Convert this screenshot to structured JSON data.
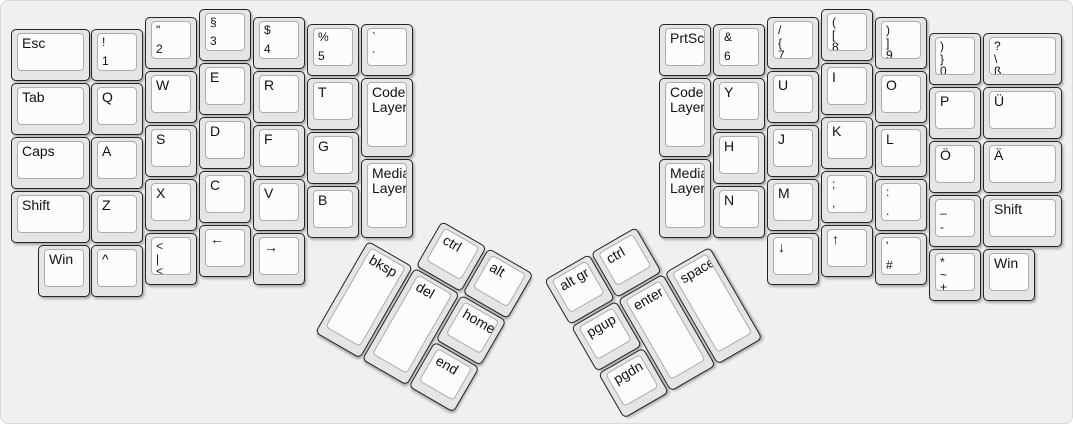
{
  "diagram": {
    "type": "split-ergonomic-keyboard-layout",
    "halves": [
      "left",
      "right"
    ],
    "layer_keys": [
      "Code Layer",
      "Media Layer"
    ]
  },
  "colors": {
    "canvas_bg": "#f0f0f0",
    "canvas_border": "#d9d9d9",
    "key_side": "#e5e5e5",
    "key_border": "#242424",
    "keytop_bg": "#fcfcfc",
    "keytop_border": "#adadad",
    "legend": "#111111"
  },
  "keyboard": {
    "unit_px": 54,
    "clusters": [
      {
        "id": "main",
        "x": 0,
        "y": 0,
        "angle": 0
      },
      {
        "id": "left-thumb",
        "x": 394,
        "y": 193,
        "angle": 30
      },
      {
        "id": "right-thumb",
        "x": 543,
        "y": 279,
        "angle": -30
      }
    ],
    "keys": [
      {
        "id": "esc",
        "cluster": "main",
        "x": 10,
        "y": 28,
        "w": 79,
        "h": 52,
        "labels": [
          "Esc"
        ]
      },
      {
        "id": "tab",
        "cluster": "main",
        "x": 10,
        "y": 82,
        "w": 79,
        "h": 52,
        "labels": [
          "Tab"
        ]
      },
      {
        "id": "caps",
        "cluster": "main",
        "x": 10,
        "y": 136,
        "w": 79,
        "h": 52,
        "labels": [
          "Caps"
        ]
      },
      {
        "id": "shift-left",
        "cluster": "main",
        "x": 10,
        "y": 190,
        "w": 79,
        "h": 52,
        "labels": [
          "Shift"
        ]
      },
      {
        "id": "win-left",
        "cluster": "main",
        "x": 37,
        "y": 244,
        "w": 52,
        "h": 52,
        "labels": [
          "Win"
        ]
      },
      {
        "id": "num1",
        "cluster": "main",
        "x": 90,
        "y": 28,
        "w": 52,
        "h": 52,
        "labels": [
          "!",
          "1"
        ]
      },
      {
        "id": "q",
        "cluster": "main",
        "x": 90,
        "y": 82,
        "w": 52,
        "h": 52,
        "labels": [
          "Q"
        ]
      },
      {
        "id": "a",
        "cluster": "main",
        "x": 90,
        "y": 136,
        "w": 52,
        "h": 52,
        "labels": [
          "A"
        ]
      },
      {
        "id": "z",
        "cluster": "main",
        "x": 90,
        "y": 190,
        "w": 52,
        "h": 52,
        "labels": [
          "Z"
        ]
      },
      {
        "id": "caret",
        "cluster": "main",
        "x": 90,
        "y": 244,
        "w": 52,
        "h": 52,
        "labels": [
          "^"
        ]
      },
      {
        "id": "num2",
        "cluster": "main",
        "x": 144,
        "y": 16,
        "w": 52,
        "h": 52,
        "labels": [
          "\"",
          "2"
        ]
      },
      {
        "id": "w",
        "cluster": "main",
        "x": 144,
        "y": 70,
        "w": 52,
        "h": 52,
        "labels": [
          "W"
        ]
      },
      {
        "id": "s",
        "cluster": "main",
        "x": 144,
        "y": 124,
        "w": 52,
        "h": 52,
        "labels": [
          "S"
        ]
      },
      {
        "id": "x",
        "cluster": "main",
        "x": 144,
        "y": 178,
        "w": 52,
        "h": 52,
        "labels": [
          "X"
        ]
      },
      {
        "id": "angle-pipe",
        "cluster": "main",
        "x": 144,
        "y": 232,
        "w": 52,
        "h": 52,
        "labels": [
          "<",
          "|",
          "<"
        ]
      },
      {
        "id": "num3",
        "cluster": "main",
        "x": 198,
        "y": 8,
        "w": 52,
        "h": 52,
        "labels": [
          "§",
          "3"
        ]
      },
      {
        "id": "e",
        "cluster": "main",
        "x": 198,
        "y": 62,
        "w": 52,
        "h": 52,
        "labels": [
          "E"
        ]
      },
      {
        "id": "d",
        "cluster": "main",
        "x": 198,
        "y": 116,
        "w": 52,
        "h": 52,
        "labels": [
          "D"
        ]
      },
      {
        "id": "c",
        "cluster": "main",
        "x": 198,
        "y": 170,
        "w": 52,
        "h": 52,
        "labels": [
          "C"
        ]
      },
      {
        "id": "arrow-left",
        "cluster": "main",
        "x": 198,
        "y": 224,
        "w": 52,
        "h": 52,
        "labels": [
          "←"
        ]
      },
      {
        "id": "num4",
        "cluster": "main",
        "x": 252,
        "y": 16,
        "w": 52,
        "h": 52,
        "labels": [
          "$",
          "4"
        ]
      },
      {
        "id": "r",
        "cluster": "main",
        "x": 252,
        "y": 70,
        "w": 52,
        "h": 52,
        "labels": [
          "R"
        ]
      },
      {
        "id": "f",
        "cluster": "main",
        "x": 252,
        "y": 124,
        "w": 52,
        "h": 52,
        "labels": [
          "F"
        ]
      },
      {
        "id": "v",
        "cluster": "main",
        "x": 252,
        "y": 178,
        "w": 52,
        "h": 52,
        "labels": [
          "V"
        ]
      },
      {
        "id": "arrow-right",
        "cluster": "main",
        "x": 252,
        "y": 232,
        "w": 52,
        "h": 52,
        "labels": [
          "→"
        ]
      },
      {
        "id": "num5",
        "cluster": "main",
        "x": 306,
        "y": 23,
        "w": 52,
        "h": 52,
        "labels": [
          "%",
          "5"
        ]
      },
      {
        "id": "t",
        "cluster": "main",
        "x": 306,
        "y": 77,
        "w": 52,
        "h": 52,
        "labels": [
          "T"
        ]
      },
      {
        "id": "g",
        "cluster": "main",
        "x": 306,
        "y": 131,
        "w": 52,
        "h": 52,
        "labels": [
          "G"
        ]
      },
      {
        "id": "b",
        "cluster": "main",
        "x": 306,
        "y": 185,
        "w": 52,
        "h": 52,
        "labels": [
          "B"
        ]
      },
      {
        "id": "grave-acute",
        "cluster": "main",
        "x": 360,
        "y": 23,
        "w": 52,
        "h": 52,
        "labels": [
          "`",
          "´"
        ]
      },
      {
        "id": "code-layer-left",
        "cluster": "main",
        "x": 360,
        "y": 77,
        "w": 52,
        "h": 79,
        "labels": [
          "Code Layer"
        ]
      },
      {
        "id": "media-layer-left",
        "cluster": "main",
        "x": 360,
        "y": 158,
        "w": 52,
        "h": 79,
        "labels": [
          "Media Layer"
        ]
      },
      {
        "id": "ctrl-left",
        "cluster": "left-thumb",
        "x": 54,
        "y": 0,
        "w": 52,
        "h": 52,
        "labels": [
          "ctrl"
        ]
      },
      {
        "id": "alt",
        "cluster": "left-thumb",
        "x": 108,
        "y": 0,
        "w": 52,
        "h": 52,
        "labels": [
          "alt"
        ]
      },
      {
        "id": "bksp",
        "cluster": "left-thumb",
        "x": 0,
        "y": 54,
        "w": 52,
        "h": 106,
        "labels": [
          "bksp"
        ]
      },
      {
        "id": "del",
        "cluster": "left-thumb",
        "x": 54,
        "y": 54,
        "w": 52,
        "h": 106,
        "labels": [
          "del"
        ]
      },
      {
        "id": "home",
        "cluster": "left-thumb",
        "x": 108,
        "y": 54,
        "w": 52,
        "h": 52,
        "labels": [
          "home"
        ]
      },
      {
        "id": "end",
        "cluster": "left-thumb",
        "x": 108,
        "y": 108,
        "w": 52,
        "h": 52,
        "labels": [
          "end"
        ]
      },
      {
        "id": "altgr",
        "cluster": "right-thumb",
        "x": 0,
        "y": 0,
        "w": 52,
        "h": 52,
        "labels": [
          "alt gr"
        ]
      },
      {
        "id": "ctrl-right",
        "cluster": "right-thumb",
        "x": 54,
        "y": 0,
        "w": 52,
        "h": 52,
        "labels": [
          "ctrl"
        ]
      },
      {
        "id": "pgup",
        "cluster": "right-thumb",
        "x": 0,
        "y": 54,
        "w": 52,
        "h": 52,
        "labels": [
          "pgup"
        ]
      },
      {
        "id": "pgdn",
        "cluster": "right-thumb",
        "x": 0,
        "y": 108,
        "w": 52,
        "h": 52,
        "labels": [
          "pgdn"
        ]
      },
      {
        "id": "enter",
        "cluster": "right-thumb",
        "x": 54,
        "y": 54,
        "w": 52,
        "h": 106,
        "labels": [
          "enter"
        ]
      },
      {
        "id": "space",
        "cluster": "right-thumb",
        "x": 108,
        "y": 54,
        "w": 52,
        "h": 106,
        "labels": [
          "space"
        ]
      },
      {
        "id": "prtscr",
        "cluster": "main",
        "x": 658,
        "y": 23,
        "w": 52,
        "h": 52,
        "labels": [
          "PrtScr"
        ]
      },
      {
        "id": "code-layer-right",
        "cluster": "main",
        "x": 658,
        "y": 77,
        "w": 52,
        "h": 79,
        "labels": [
          "Code Layer"
        ]
      },
      {
        "id": "media-layer-right",
        "cluster": "main",
        "x": 658,
        "y": 158,
        "w": 52,
        "h": 79,
        "labels": [
          "Media Layer"
        ]
      },
      {
        "id": "num6",
        "cluster": "main",
        "x": 712,
        "y": 23,
        "w": 52,
        "h": 52,
        "labels": [
          "&",
          "6"
        ]
      },
      {
        "id": "y",
        "cluster": "main",
        "x": 712,
        "y": 77,
        "w": 52,
        "h": 52,
        "labels": [
          "Y"
        ]
      },
      {
        "id": "h",
        "cluster": "main",
        "x": 712,
        "y": 131,
        "w": 52,
        "h": 52,
        "labels": [
          "H"
        ]
      },
      {
        "id": "n",
        "cluster": "main",
        "x": 712,
        "y": 185,
        "w": 52,
        "h": 52,
        "labels": [
          "N"
        ]
      },
      {
        "id": "num7",
        "cluster": "main",
        "x": 766,
        "y": 16,
        "w": 52,
        "h": 52,
        "labels": [
          "/",
          "{",
          "7"
        ]
      },
      {
        "id": "u",
        "cluster": "main",
        "x": 766,
        "y": 70,
        "w": 52,
        "h": 52,
        "labels": [
          "U"
        ]
      },
      {
        "id": "j",
        "cluster": "main",
        "x": 766,
        "y": 124,
        "w": 52,
        "h": 52,
        "labels": [
          "J"
        ]
      },
      {
        "id": "m",
        "cluster": "main",
        "x": 766,
        "y": 178,
        "w": 52,
        "h": 52,
        "labels": [
          "M"
        ]
      },
      {
        "id": "arrow-down",
        "cluster": "main",
        "x": 766,
        "y": 232,
        "w": 52,
        "h": 52,
        "labels": [
          "↓"
        ]
      },
      {
        "id": "num8",
        "cluster": "main",
        "x": 820,
        "y": 8,
        "w": 52,
        "h": 52,
        "labels": [
          "(",
          "[",
          "8"
        ]
      },
      {
        "id": "i",
        "cluster": "main",
        "x": 820,
        "y": 62,
        "w": 52,
        "h": 52,
        "labels": [
          "I"
        ]
      },
      {
        "id": "k",
        "cluster": "main",
        "x": 820,
        "y": 116,
        "w": 52,
        "h": 52,
        "labels": [
          "K"
        ]
      },
      {
        "id": "semicolon",
        "cluster": "main",
        "x": 820,
        "y": 170,
        "w": 52,
        "h": 52,
        "labels": [
          ";",
          ","
        ]
      },
      {
        "id": "arrow-up",
        "cluster": "main",
        "x": 820,
        "y": 224,
        "w": 52,
        "h": 52,
        "labels": [
          "↑"
        ]
      },
      {
        "id": "num9",
        "cluster": "main",
        "x": 874,
        "y": 16,
        "w": 52,
        "h": 52,
        "labels": [
          ")",
          "]",
          "9"
        ]
      },
      {
        "id": "o",
        "cluster": "main",
        "x": 874,
        "y": 70,
        "w": 52,
        "h": 52,
        "labels": [
          "O"
        ]
      },
      {
        "id": "l",
        "cluster": "main",
        "x": 874,
        "y": 124,
        "w": 52,
        "h": 52,
        "labels": [
          "L"
        ]
      },
      {
        "id": "colon",
        "cluster": "main",
        "x": 874,
        "y": 178,
        "w": 52,
        "h": 52,
        "labels": [
          ":",
          "."
        ]
      },
      {
        "id": "quote-hash",
        "cluster": "main",
        "x": 874,
        "y": 232,
        "w": 52,
        "h": 52,
        "labels": [
          "'",
          "#"
        ]
      },
      {
        "id": "num0",
        "cluster": "main",
        "x": 928,
        "y": 32,
        "w": 52,
        "h": 52,
        "labels": [
          ")",
          "}",
          "0"
        ]
      },
      {
        "id": "p",
        "cluster": "main",
        "x": 928,
        "y": 86,
        "w": 52,
        "h": 52,
        "labels": [
          "P"
        ]
      },
      {
        "id": "o-umlaut",
        "cluster": "main",
        "x": 928,
        "y": 140,
        "w": 52,
        "h": 52,
        "labels": [
          "Ö"
        ]
      },
      {
        "id": "underscore",
        "cluster": "main",
        "x": 928,
        "y": 194,
        "w": 52,
        "h": 52,
        "labels": [
          "_",
          "-"
        ]
      },
      {
        "id": "asterisk-plus",
        "cluster": "main",
        "x": 928,
        "y": 248,
        "w": 52,
        "h": 52,
        "labels": [
          "*",
          "~",
          "+"
        ]
      },
      {
        "id": "question-sz",
        "cluster": "main",
        "x": 982,
        "y": 32,
        "w": 79,
        "h": 52,
        "labels": [
          "?",
          "\\",
          "ß"
        ]
      },
      {
        "id": "u-umlaut",
        "cluster": "main",
        "x": 982,
        "y": 86,
        "w": 79,
        "h": 52,
        "labels": [
          "Ü"
        ]
      },
      {
        "id": "a-umlaut",
        "cluster": "main",
        "x": 982,
        "y": 140,
        "w": 79,
        "h": 52,
        "labels": [
          "Ä"
        ]
      },
      {
        "id": "shift-right",
        "cluster": "main",
        "x": 982,
        "y": 194,
        "w": 79,
        "h": 52,
        "labels": [
          "Shift"
        ]
      },
      {
        "id": "win-right",
        "cluster": "main",
        "x": 982,
        "y": 248,
        "w": 52,
        "h": 52,
        "labels": [
          "Win"
        ]
      }
    ]
  }
}
